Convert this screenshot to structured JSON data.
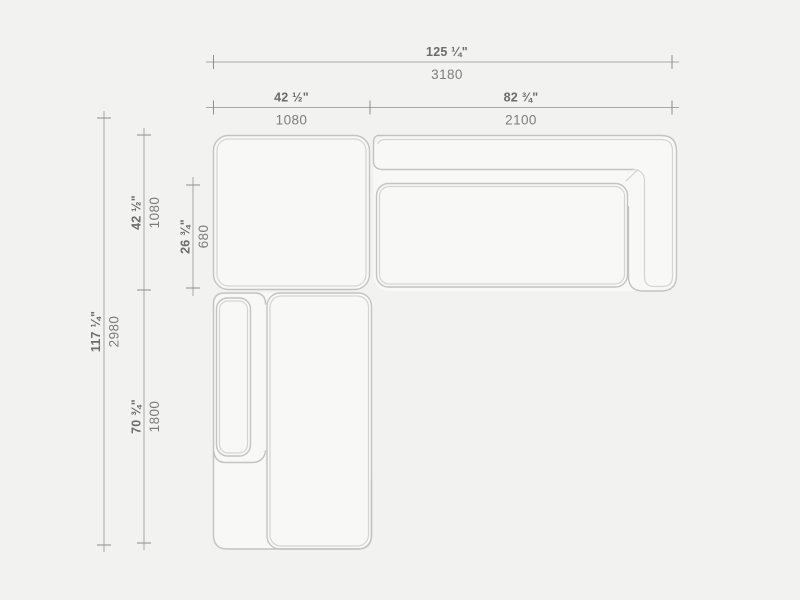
{
  "drawing": {
    "description": "Top-view technical drawing of a modular corner sofa with dimension lines",
    "units": [
      "inches",
      "mm"
    ],
    "dimensions": {
      "overall_width": {
        "inches": "125 ¼\"",
        "mm": "3180"
      },
      "corner_module_width": {
        "inches": "42 ½\"",
        "mm": "1080"
      },
      "right_module_width": {
        "inches": "82 ¾\"",
        "mm": "2100"
      },
      "overall_depth": {
        "inches": "117 ¼\"",
        "mm": "2980"
      },
      "corner_module_depth": {
        "inches": "42 ½\"",
        "mm": "1080"
      },
      "seat_depth": {
        "inches": "26 ¾\"",
        "mm": "680"
      },
      "chaise_module_depth": {
        "inches": "70 ¾\"",
        "mm": "1800"
      }
    },
    "colors": {
      "background": "#f2f2f1",
      "module_fill": "#f8f8f7",
      "outline": "#c3c3c2",
      "inner_line": "#d4d4d3",
      "dimension_line": "#a8a8a7",
      "dimension_text_inches": "#6c6c6b",
      "dimension_text_mm": "#7d7d7c"
    }
  }
}
